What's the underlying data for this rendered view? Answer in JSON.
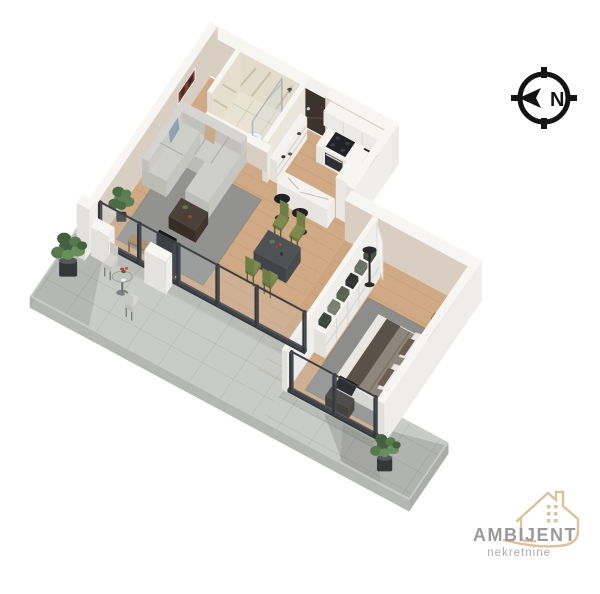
{
  "compass": {
    "label": "N",
    "color": "#141414"
  },
  "logo": {
    "brand": "AMBIJENT",
    "subtitle": "nekretnine",
    "accent_color": "#d9c29c",
    "text_color": "#9a9a9a",
    "subtitle_color": "#ababab"
  },
  "icons": [
    {
      "name": "compass-north-icon",
      "glyph": "N"
    },
    {
      "name": "house-outline-icon"
    }
  ],
  "palette": {
    "background": "#ffffff",
    "terrace_tile": "#c9cbc7",
    "wood_floor": "#d0a985",
    "wall_white_top": "#f7f6f3",
    "wall_beige": "#d8cec1",
    "marble": "#e8e2d2",
    "rug_gray": "#929390",
    "chair_olive": "#7c8a4f",
    "door_brown": "#3b332c",
    "appliance_black": "#202225"
  }
}
